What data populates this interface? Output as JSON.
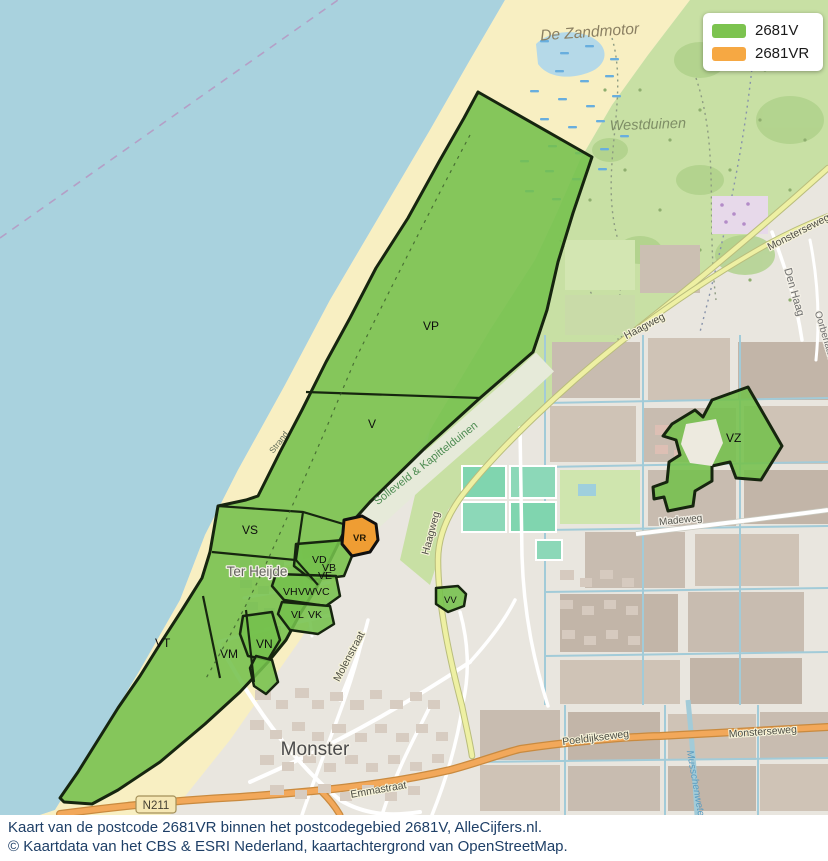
{
  "legend": {
    "items": [
      {
        "label": "2681V",
        "color": "#7cc34f"
      },
      {
        "label": "2681VR",
        "color": "#f6a843"
      }
    ]
  },
  "regions": {
    "vp": "VP",
    "v": "V",
    "vs": "VS",
    "vt": "VT",
    "vm": "VM",
    "vn": "VN",
    "vd": "VD",
    "vb": "VB",
    "ve": "VE",
    "vh": "VH",
    "vw": "VW",
    "vc": "VC",
    "vl": "VL",
    "vk": "VK",
    "vr": "VR",
    "vv": "VV",
    "vz": "VZ"
  },
  "places": {
    "de_zandmotor": "De Zandmotor",
    "westduinen": "Westduinen",
    "ter_heijde": "Ter Heijde",
    "monster": "Monster",
    "strand": "Strand",
    "den_haag": "Den Haag",
    "oorberlaan": "Oorberlaan",
    "solleveld": "Solleveld & Kapittelduinen",
    "madeweg": "Madeweg",
    "musschenwetering": "Musschenwetering"
  },
  "roads": {
    "haagweg": "Haagweg",
    "haagweg2": "Haagweg",
    "molenstraat": "Molenstraat",
    "emmastraat": "Emmastraat",
    "poeldijkseweg": "Poeldijkseweg",
    "monsterseweg": "Monsterseweg",
    "monsterseweg_top": "Monsterseweg",
    "n211": "N211"
  },
  "caption": {
    "line1": "Kaart van de postcode 2681VR binnen het postcodegebied 2681V, AlleCijfers.nl.",
    "line2": "© Kaartdata van het CBS & ESRI Nederland, kaartachtergrond van OpenStreetMap."
  },
  "colors": {
    "overlay_green": "#74c04c",
    "overlay_orange": "#ef9d33",
    "sea": "#a9d2de",
    "sand": "#f8efc2",
    "dune": "#c8e0a4"
  }
}
